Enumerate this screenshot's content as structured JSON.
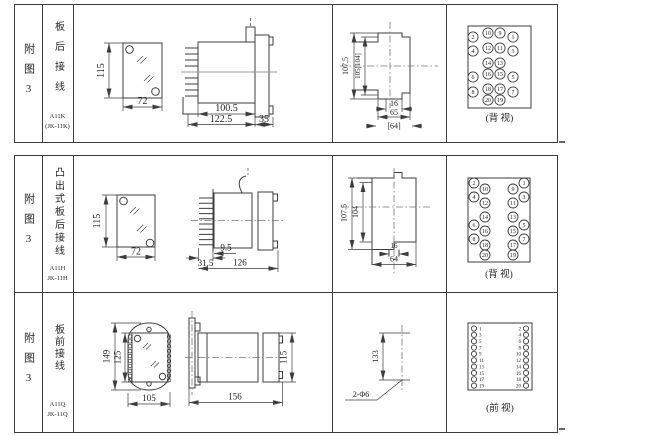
{
  "colors": {
    "line": "#3d3d3d",
    "text": "#242424",
    "centerline": "#777777",
    "bg": "#ffffff"
  },
  "rows": [
    {
      "figure_text": "附图3",
      "type_text": "板后接线",
      "model_line1": "A11K",
      "model_line2": "(JK-11K)",
      "front": {
        "h": "115",
        "w": "72"
      },
      "side": {
        "d1": "100.5",
        "d2": "122.5",
        "d3": "35"
      },
      "panel": {
        "d1": "107.5",
        "d2": "105[104]",
        "d3": "16",
        "d4": "65",
        "d5": "[64]"
      },
      "view_label": "(背 视)",
      "terminals": [
        "2",
        "10",
        "9",
        "1",
        "4",
        "12",
        "11",
        "3",
        "14",
        "13",
        "6",
        "16",
        "15",
        "5",
        "8",
        "18",
        "17",
        "7",
        "20",
        "19"
      ]
    },
    {
      "figure_text": "附图3",
      "type_text": "凸出式板后接线",
      "model_line1": "A11H",
      "model_line2": "JK-11H",
      "front": {
        "h": "115",
        "w": "72"
      },
      "side": {
        "d1": "31.5",
        "d2": "9.5",
        "d3": "126"
      },
      "panel": {
        "d1": "107.5",
        "d2": "104",
        "d3": "16",
        "d4": "64"
      },
      "view_label": "(背 视)",
      "terminals": [
        "2",
        "10",
        "4",
        "12",
        "14",
        "6",
        "16",
        "8",
        "18",
        "20",
        "1",
        "9",
        "3",
        "11",
        "13",
        "5",
        "15",
        "7",
        "17",
        "19"
      ]
    },
    {
      "figure_text": "附图3",
      "type_text": "板前接线",
      "model_line1": "A11Q",
      "model_line2": "JK-11Q",
      "front": {
        "h": "149",
        "h2": "125",
        "w": "105"
      },
      "side": {
        "d1": "156",
        "d2": "115"
      },
      "drill": {
        "d1": "133",
        "d2": "2-Φ6"
      },
      "view_label": "(前 视)",
      "terminals_left": [
        "1",
        "3",
        "5",
        "7",
        "9",
        "11",
        "13",
        "15",
        "17",
        "19"
      ],
      "terminals_right": [
        "2",
        "4",
        "6",
        "8",
        "10",
        "12",
        "14",
        "16",
        "18",
        "20"
      ]
    }
  ]
}
